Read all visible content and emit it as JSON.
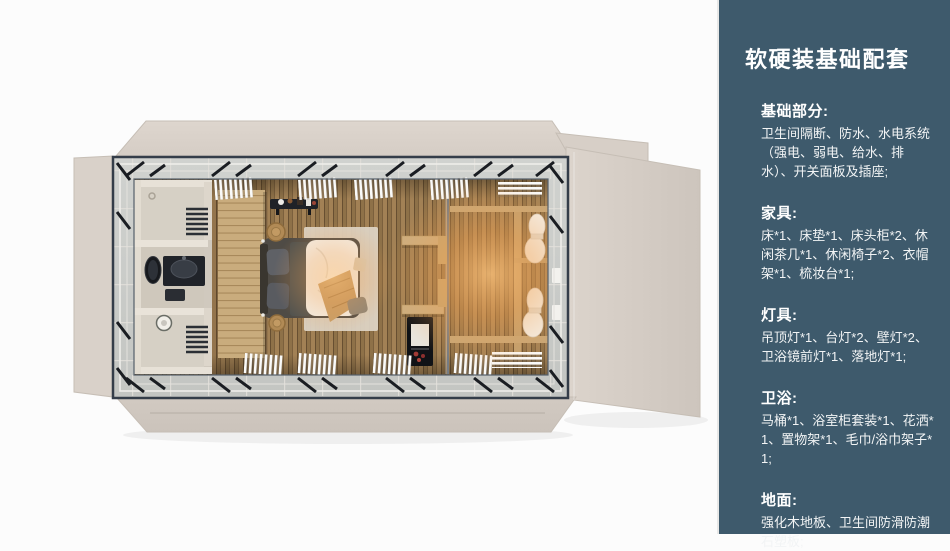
{
  "panel": {
    "title": "软硬装基础配套",
    "bg_color": "#3e5a6c",
    "text_color": "#ffffff",
    "sections": [
      {
        "heading": "基础部分:",
        "body": "卫生间隔断、防水、水电系统（强电、弱电、给水、排水）、开关面板及插座;"
      },
      {
        "heading": "家具:",
        "body": "床*1、床垫*1、床头柜*2、休闲茶几*1、休闲椅子*2、衣帽架*1、梳妆台*1;"
      },
      {
        "heading": "灯具:",
        "body": "吊顶灯*1、台灯*2、壁灯*2、卫浴镜前灯*1、落地灯*1;"
      },
      {
        "heading": "卫浴:",
        "body": "马桶*1、浴室柜套装*1、花洒*1、置物架*1、毛巾/浴巾架子*1;"
      },
      {
        "heading": "地面:",
        "body": "强化木地板、卫生间防滑防潮石塑板;"
      }
    ]
  },
  "floorplan": {
    "colors": {
      "exterior_wall": "#d8d0c8",
      "roof_frame": "#39424e",
      "glazing_band": "#c9cbc8",
      "wood_floor": "#a2815",
      "warm_light": "#ffc278",
      "wardrobe_wood": "#c9ac7d",
      "bedding": "#f3f0ea",
      "rug": "#dcd2c3"
    }
  }
}
